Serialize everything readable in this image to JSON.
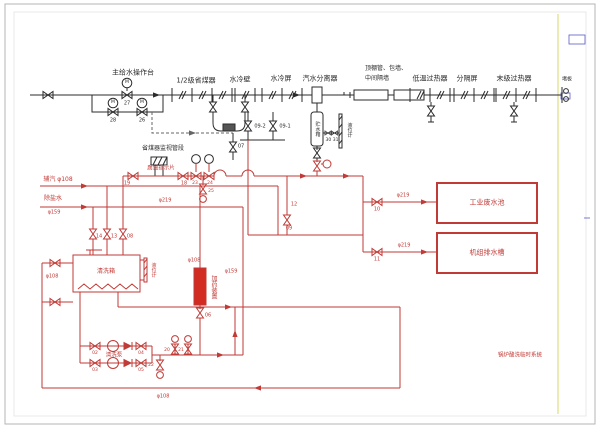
{
  "colors": {
    "pipe_red": "#c03a36",
    "line_black": "#2b2b2b",
    "frame_yellow": "#e6e6a0",
    "mark_blue": "#5a5ac8"
  },
  "labels": {
    "main_station": "主给水操作台",
    "economizer": "1/2级省煤器",
    "water_wall": "水冷壁",
    "water_screen": "水冷屏",
    "separator": "汽水分离器",
    "ceiling_line1": "顶棚管、包墙、",
    "ceiling_line2": "中间隔墙",
    "low_temp_superheater": "低温过热器",
    "partition_screen": "分隔屏",
    "final_superheater": "末级过热器",
    "blank_plate": "堵板",
    "monitor_section": "省煤器监视管段",
    "corrosion_strip": "腐蚀指示片",
    "storage_tank": "贮水箱",
    "level_gauge_1": "液位计",
    "level_gauge_2": "液位计",
    "aux_steam": "辅汽 φ108",
    "demin_water": "除盐水",
    "demin_size": "φ159",
    "wash_tank": "清洗箱",
    "wash_pump": "清洗泵",
    "dosing_device": "加药装置",
    "waste_pool": "工业废水池",
    "unit_drain_tank": "机组排水槽",
    "system_title": "锅炉酸洗临时系统",
    "motor_m": "M",
    "phi219_monitor": "φ219",
    "phi219_waste": "φ219",
    "phi219_drain": "φ219",
    "phi108_tank": "φ108",
    "phi108_dosing": "φ108",
    "phi108_bottom": "φ108",
    "phi159_mid": "φ159",
    "line_12": "12"
  },
  "valve_numbers": {
    "v27": "27",
    "v28": "28",
    "v26": "26",
    "v07": "07",
    "v09_2": "09-2",
    "v09_1": "09-1",
    "v30_31": "30 31",
    "v19": "19",
    "v18": "18",
    "v23": "23",
    "v24": "24",
    "v25": "25",
    "v14": "14",
    "v13": "13",
    "v08": "08",
    "v09": "09",
    "v10": "10",
    "v11": "11",
    "v02": "02",
    "v03": "03",
    "v04": "04",
    "v05": "05",
    "v06": "06",
    "v20": "20",
    "v21": "21",
    "v22": "22"
  }
}
